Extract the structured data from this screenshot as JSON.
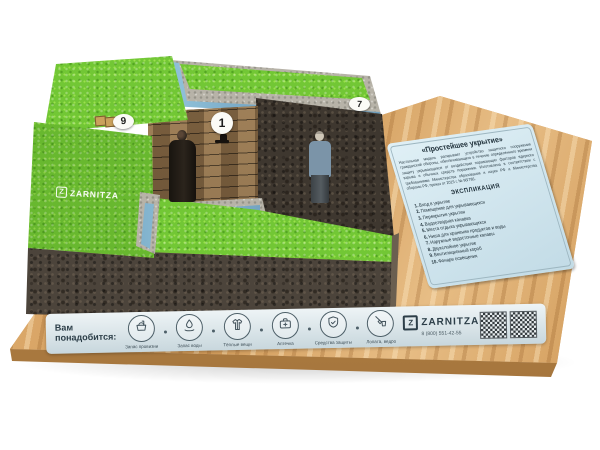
{
  "scene": {
    "description": "Фото настольного учебного макета защитного сооружения на деревянной подставке"
  },
  "model": {
    "logo": {
      "mark": "Z",
      "text": "ZARNITZA"
    },
    "markers": [
      {
        "num": "1"
      },
      {
        "num": "7"
      },
      {
        "num": "9"
      }
    ]
  },
  "info_panel": {
    "title": "«Простейшее укрытие»",
    "description": "Настольная модель раскрывает устройство защитного сооружения гражданской обороны, обеспечивающего в течение определенного времени защиту укрывающихся от воздействия поражающих факторов ядерного взрыва и обычных средств поражения. Изготовлена в соответствии с требованиями Министерства образования и науки РФ и Министерства обороны РФ, приказ от 2015 г. № 96/786.",
    "explication_title": "ЭКСПЛИКАЦИЯ",
    "items": [
      {
        "num": "1.",
        "label": "Вход в укрытие"
      },
      {
        "num": "2.",
        "label": "Помещение для укрывающихся"
      },
      {
        "num": "3.",
        "label": "Перекрытие укрытия"
      },
      {
        "num": "4.",
        "label": "Водоотводная канавка"
      },
      {
        "num": "5.",
        "label": "Места отдыха укрывающихся"
      },
      {
        "num": "6.",
        "label": "Ниша для хранения продуктов и воды"
      },
      {
        "num": "7.",
        "label": "Наружные водосточные канавы"
      },
      {
        "num": "8.",
        "label": "Двухслойное укрытие"
      },
      {
        "num": "9.",
        "label": "Вентиляционный короб"
      },
      {
        "num": "10.",
        "label": "Фонари освещения"
      }
    ]
  },
  "bottom_strip": {
    "label": "Вам понадобится:",
    "icons": [
      {
        "name": "basket-icon",
        "label": "Запас провизии"
      },
      {
        "name": "water-icon",
        "label": "Запас воды"
      },
      {
        "name": "coat-icon",
        "label": "Тёплые вещи"
      },
      {
        "name": "first-aid-icon",
        "label": "Аптечка"
      },
      {
        "name": "shield-icon",
        "label": "Средства защиты"
      },
      {
        "name": "shovel-icon",
        "label": "Лопата, ведро"
      }
    ],
    "brand": {
      "mark": "Z",
      "name": "ZARNITZA",
      "phone": "8 (800) 551-42-55"
    }
  },
  "colors": {
    "grass": "#72c735",
    "soil": "#4c443b",
    "wood": "#d8a263",
    "panel": "#d4e7ee",
    "channel": "#5b87a8",
    "strip": "#d9e4e8"
  }
}
